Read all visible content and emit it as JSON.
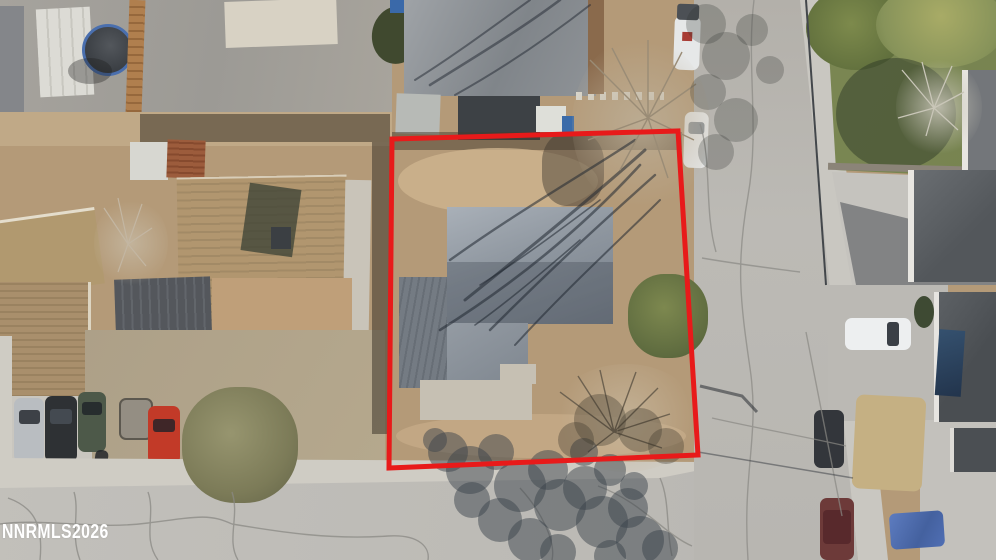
{
  "watermark": {
    "text": "NNRMLS2026",
    "color": "#ffffff"
  },
  "property_boundary": {
    "points": "392,139 678,131 698,455 389,468",
    "color": "#e81a1a",
    "stroke_width": 5
  },
  "colors": {
    "dirt_lot": "#b49a78",
    "asphalt_street": "#bdbbb6",
    "sidewalk_concrete": "#cfccc4",
    "subject_roof_gray": "#9aa1ab",
    "neighbor_roof_brown": "#ac9270",
    "lawn_green": "#7e8a55",
    "rust_shed_roof": "#9c5c3c",
    "trampoline_mat": "#42464b",
    "red_car": "#c23a28",
    "white_truck": "#edeff0",
    "blue_tarp": "#4d6cb0",
    "boundary_red": "#e81a1a"
  }
}
